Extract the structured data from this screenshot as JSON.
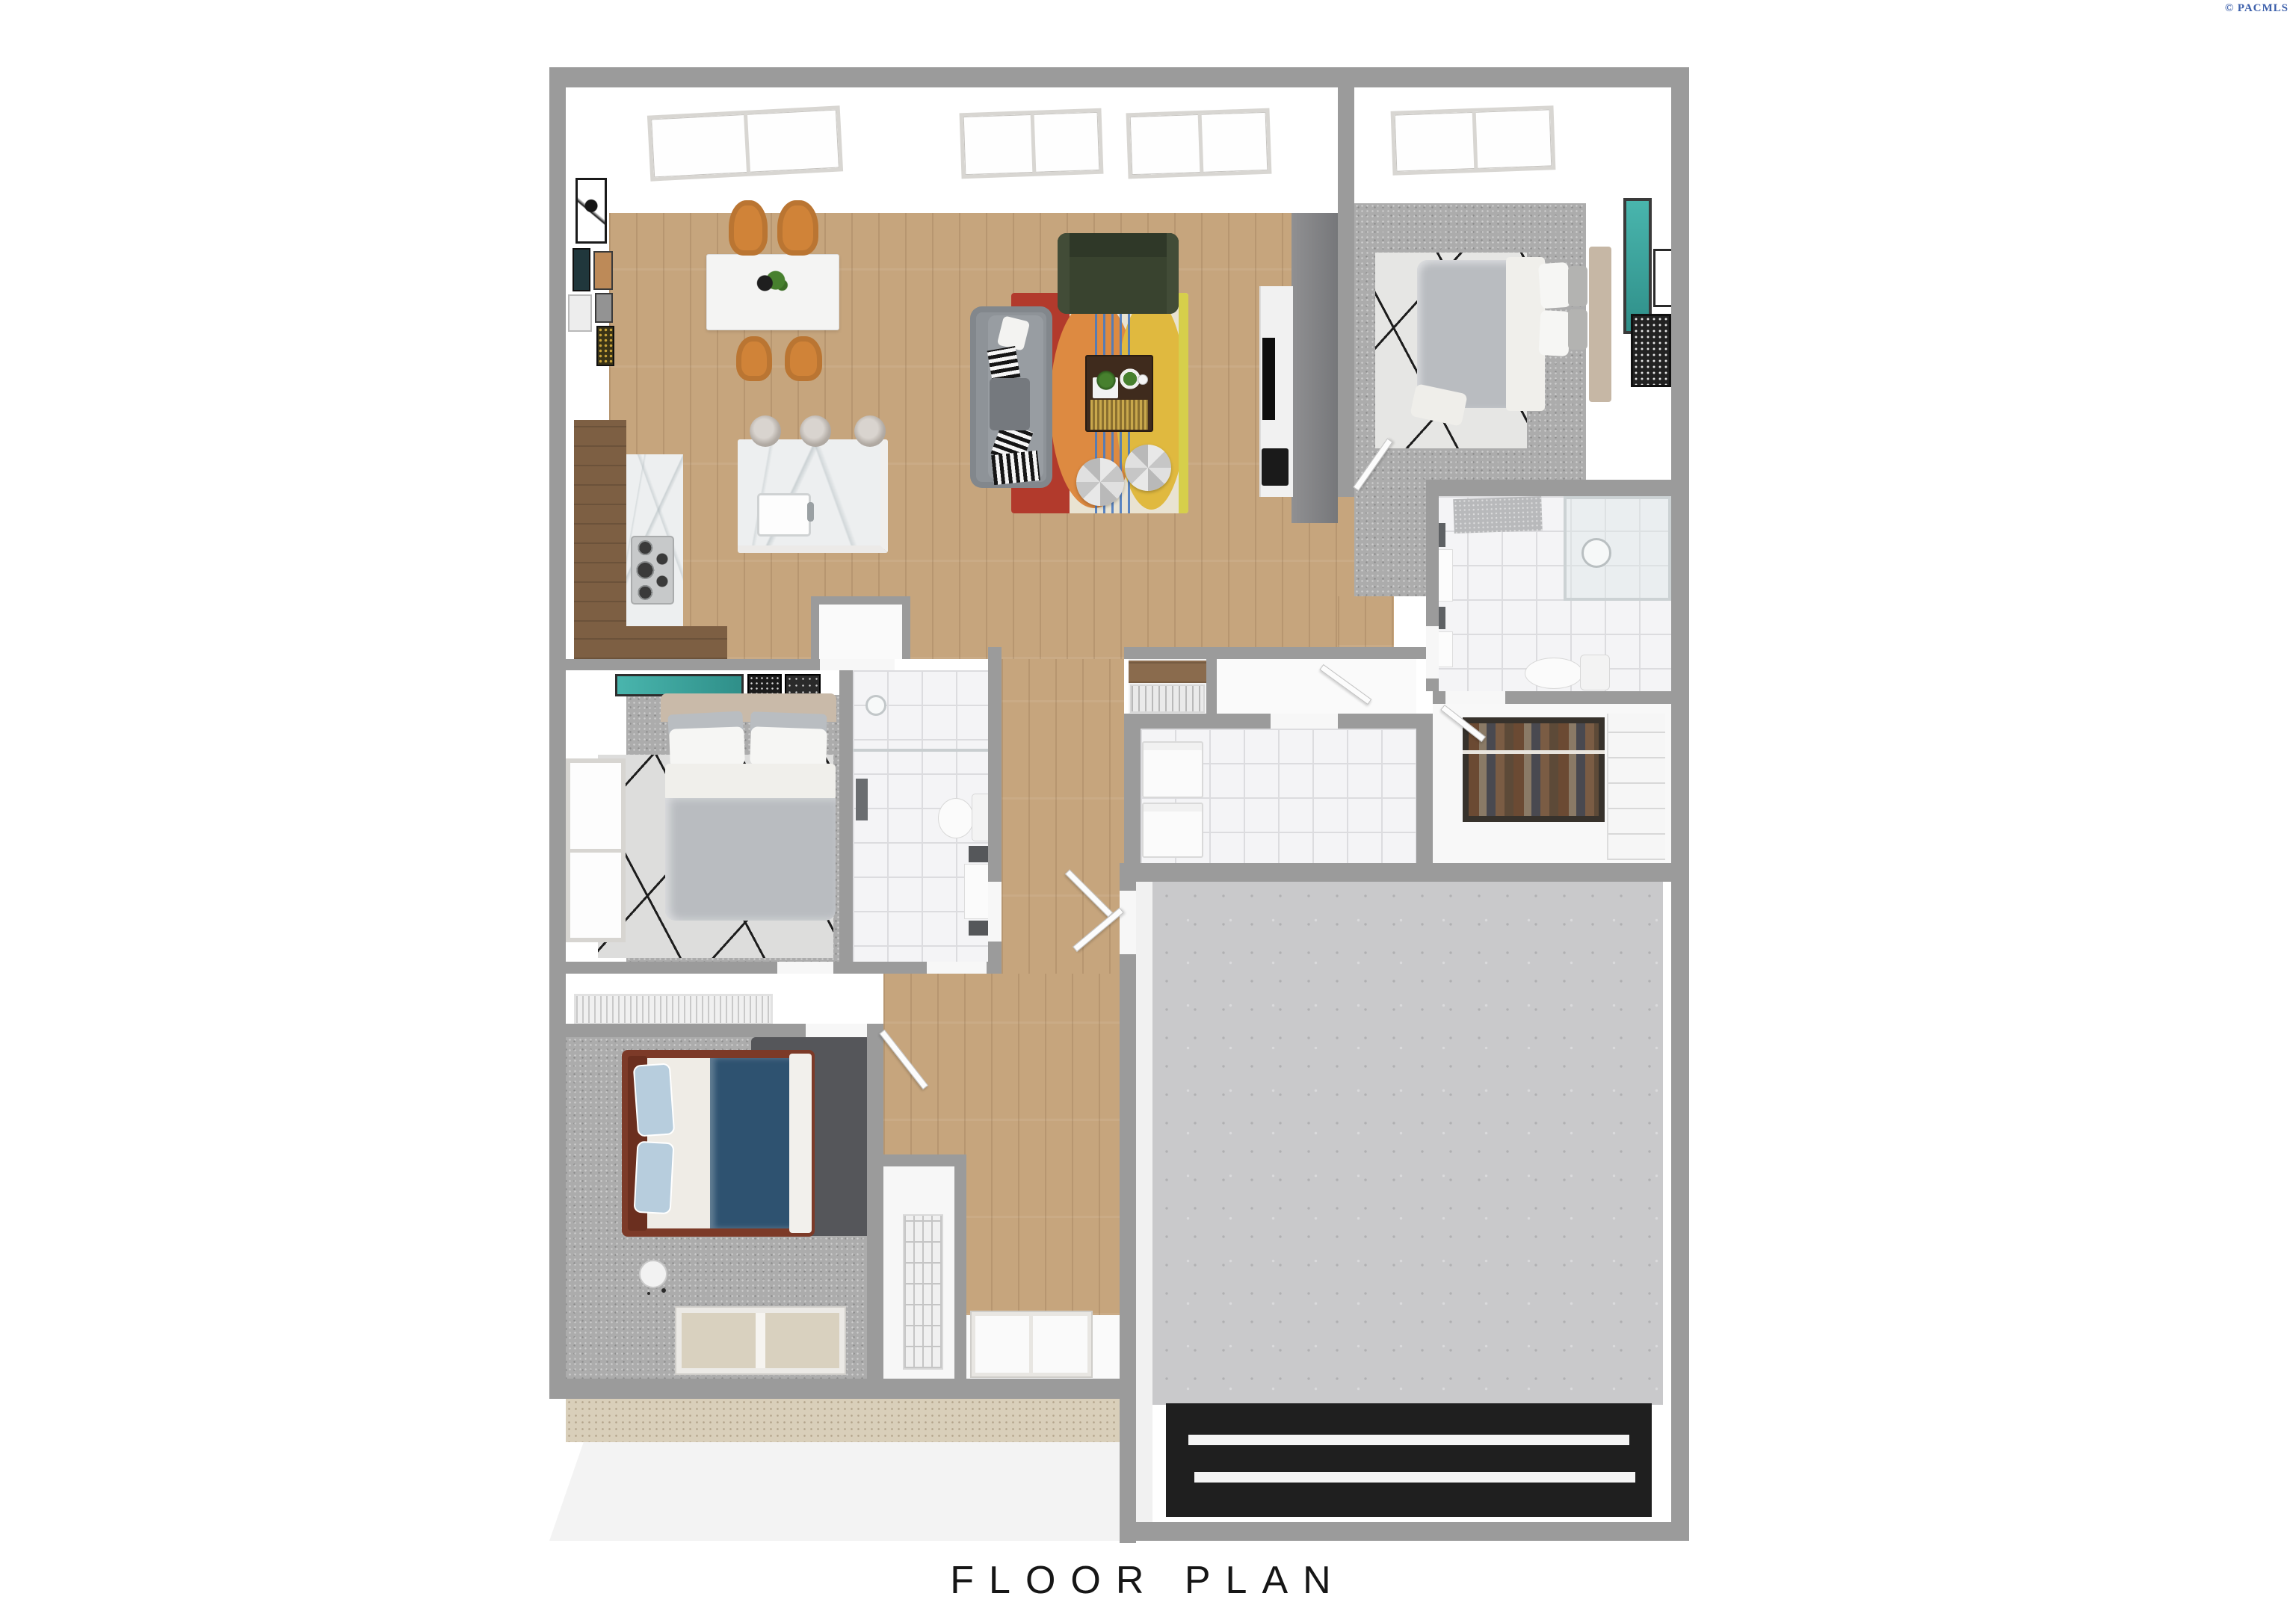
{
  "header": {
    "copyright": "© PACMLS"
  },
  "caption": {
    "title": "FLOOR PLAN"
  },
  "palette": {
    "wall_gray": "#9b9b9b",
    "wood_floor": "#c6a57d",
    "dark_wood_counter": "#7d5f43",
    "carpet_gray": "#acacac",
    "tile_white": "#f4f4f6",
    "concrete_gray": "#c9c9cb",
    "porch_beige": "#d9cfba",
    "accent_wall_gray": "#85868a",
    "marble_white": "#edeff0",
    "rug_red": "#b23a2c",
    "rug_orange": "#dd8a41",
    "rug_yellow": "#e0b93f",
    "rug_blue_stripe": "#4a7abf",
    "dining_chair_orange": "#d08338",
    "sofa_gray": "#8e9398",
    "loveseat_green": "#39432f",
    "duvet_gray": "#b9bcc0",
    "bed3_duvet_blue": "#2e5270",
    "bed3_frame_brown": "#7c3a28",
    "artwork_teal": "#3aa9a2",
    "garage_mat_black": "#1f1f1f",
    "copyright_blue": "#3d60ab"
  },
  "rooms": [
    "living-room",
    "dining-area",
    "kitchen",
    "master-bedroom",
    "master-bathroom",
    "walk-in-closet",
    "laundry-room",
    "pantry",
    "entry-hall",
    "bedroom-2",
    "ensuite-bathroom",
    "hallway",
    "bedroom-3",
    "closet",
    "garage",
    "porch",
    "driveway"
  ],
  "fixtures": {
    "skylights": 4,
    "windows": 2,
    "exterior_doors": 2
  },
  "furniture": [
    "dining-table",
    "dining-chairs",
    "kitchen-island",
    "bar-stools",
    "gas-cooktop",
    "kitchen-sink",
    "gray-sofa",
    "green-loveseat",
    "coffee-table",
    "ottomans",
    "multicolor-area-rug",
    "tv-console",
    "television",
    "master-bed",
    "bedroom-2-bed",
    "bedroom-3-bed",
    "washer",
    "dryer",
    "toilets",
    "shower",
    "vanities",
    "wardrobe",
    "floor-lamp",
    "gallery-wall-frames",
    "teal-artworks"
  ]
}
